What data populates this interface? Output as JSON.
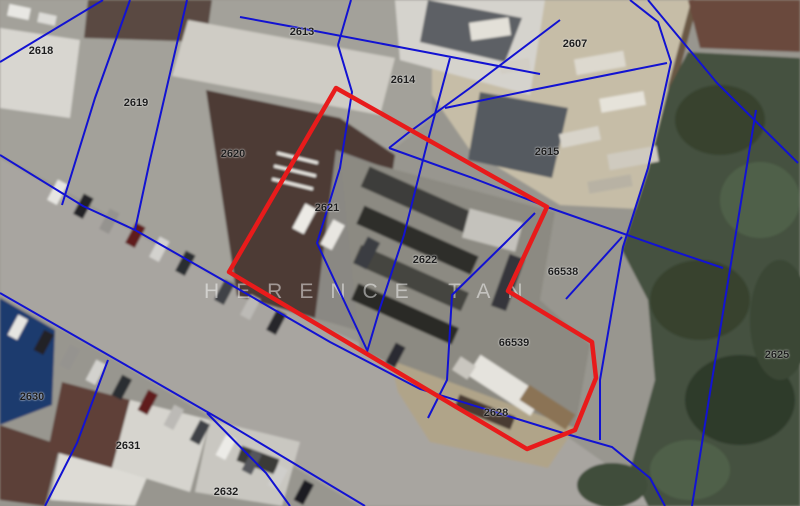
{
  "map": {
    "watermark": {
      "text": "HERENCE TAN"
    },
    "colors": {
      "parcel_line": "#1212d2",
      "highlight": "#e81b1b",
      "label": "#1c1c1c"
    },
    "highlight_parcel": {
      "name": "selected-parcels-outline",
      "points": "336,88 547,207 508,291 592,342 596,378 575,430 527,449 229,272"
    },
    "parcel_lines": [
      "0,62 103,0",
      "130,0 95,98 62,205",
      "187,0 150,160 135,230",
      "0,155 83,206 135,230 228,283 330,342 420,389 563,433 612,447 650,478 665,506",
      "0,293 117,360 230,425 365,506",
      "351,0 338,45",
      "240,17 294,27 420,51 540,74",
      "338,45 352,92 340,168 317,243 367,350",
      "560,20 470,88 408,133 389,148",
      "389,148 470,177 550,208 670,250 723,268",
      "445,108 532,90 667,63",
      "630,0 658,22 671,62 648,168 623,247 612,310 600,380 600,440",
      "648,0 717,83 798,163",
      "756,110 725,300 712,380 692,506",
      "450,58 428,140 404,235 380,308 367,352",
      "535,213 505,243 452,295 447,380 428,418",
      "622,237 566,299",
      "108,360 77,443 45,506",
      "207,413 266,473 290,506"
    ],
    "parcel_labels": [
      {
        "id": "2618",
        "x": 41,
        "y": 51
      },
      {
        "id": "2619",
        "x": 136,
        "y": 103
      },
      {
        "id": "2620",
        "x": 233,
        "y": 154
      },
      {
        "id": "2621",
        "x": 327,
        "y": 208
      },
      {
        "id": "2622",
        "x": 425,
        "y": 260
      },
      {
        "id": "2613",
        "x": 302,
        "y": 32
      },
      {
        "id": "2614",
        "x": 403,
        "y": 80
      },
      {
        "id": "2607",
        "x": 575,
        "y": 44
      },
      {
        "id": "2615",
        "x": 547,
        "y": 152
      },
      {
        "id": "66538",
        "x": 563,
        "y": 272
      },
      {
        "id": "66539",
        "x": 514,
        "y": 343
      },
      {
        "id": "2628",
        "x": 496,
        "y": 413
      },
      {
        "id": "2625",
        "x": 777,
        "y": 355
      },
      {
        "id": "2630",
        "x": 32,
        "y": 397
      },
      {
        "id": "2631",
        "x": 128,
        "y": 446
      },
      {
        "id": "2632",
        "x": 226,
        "y": 492
      }
    ]
  }
}
